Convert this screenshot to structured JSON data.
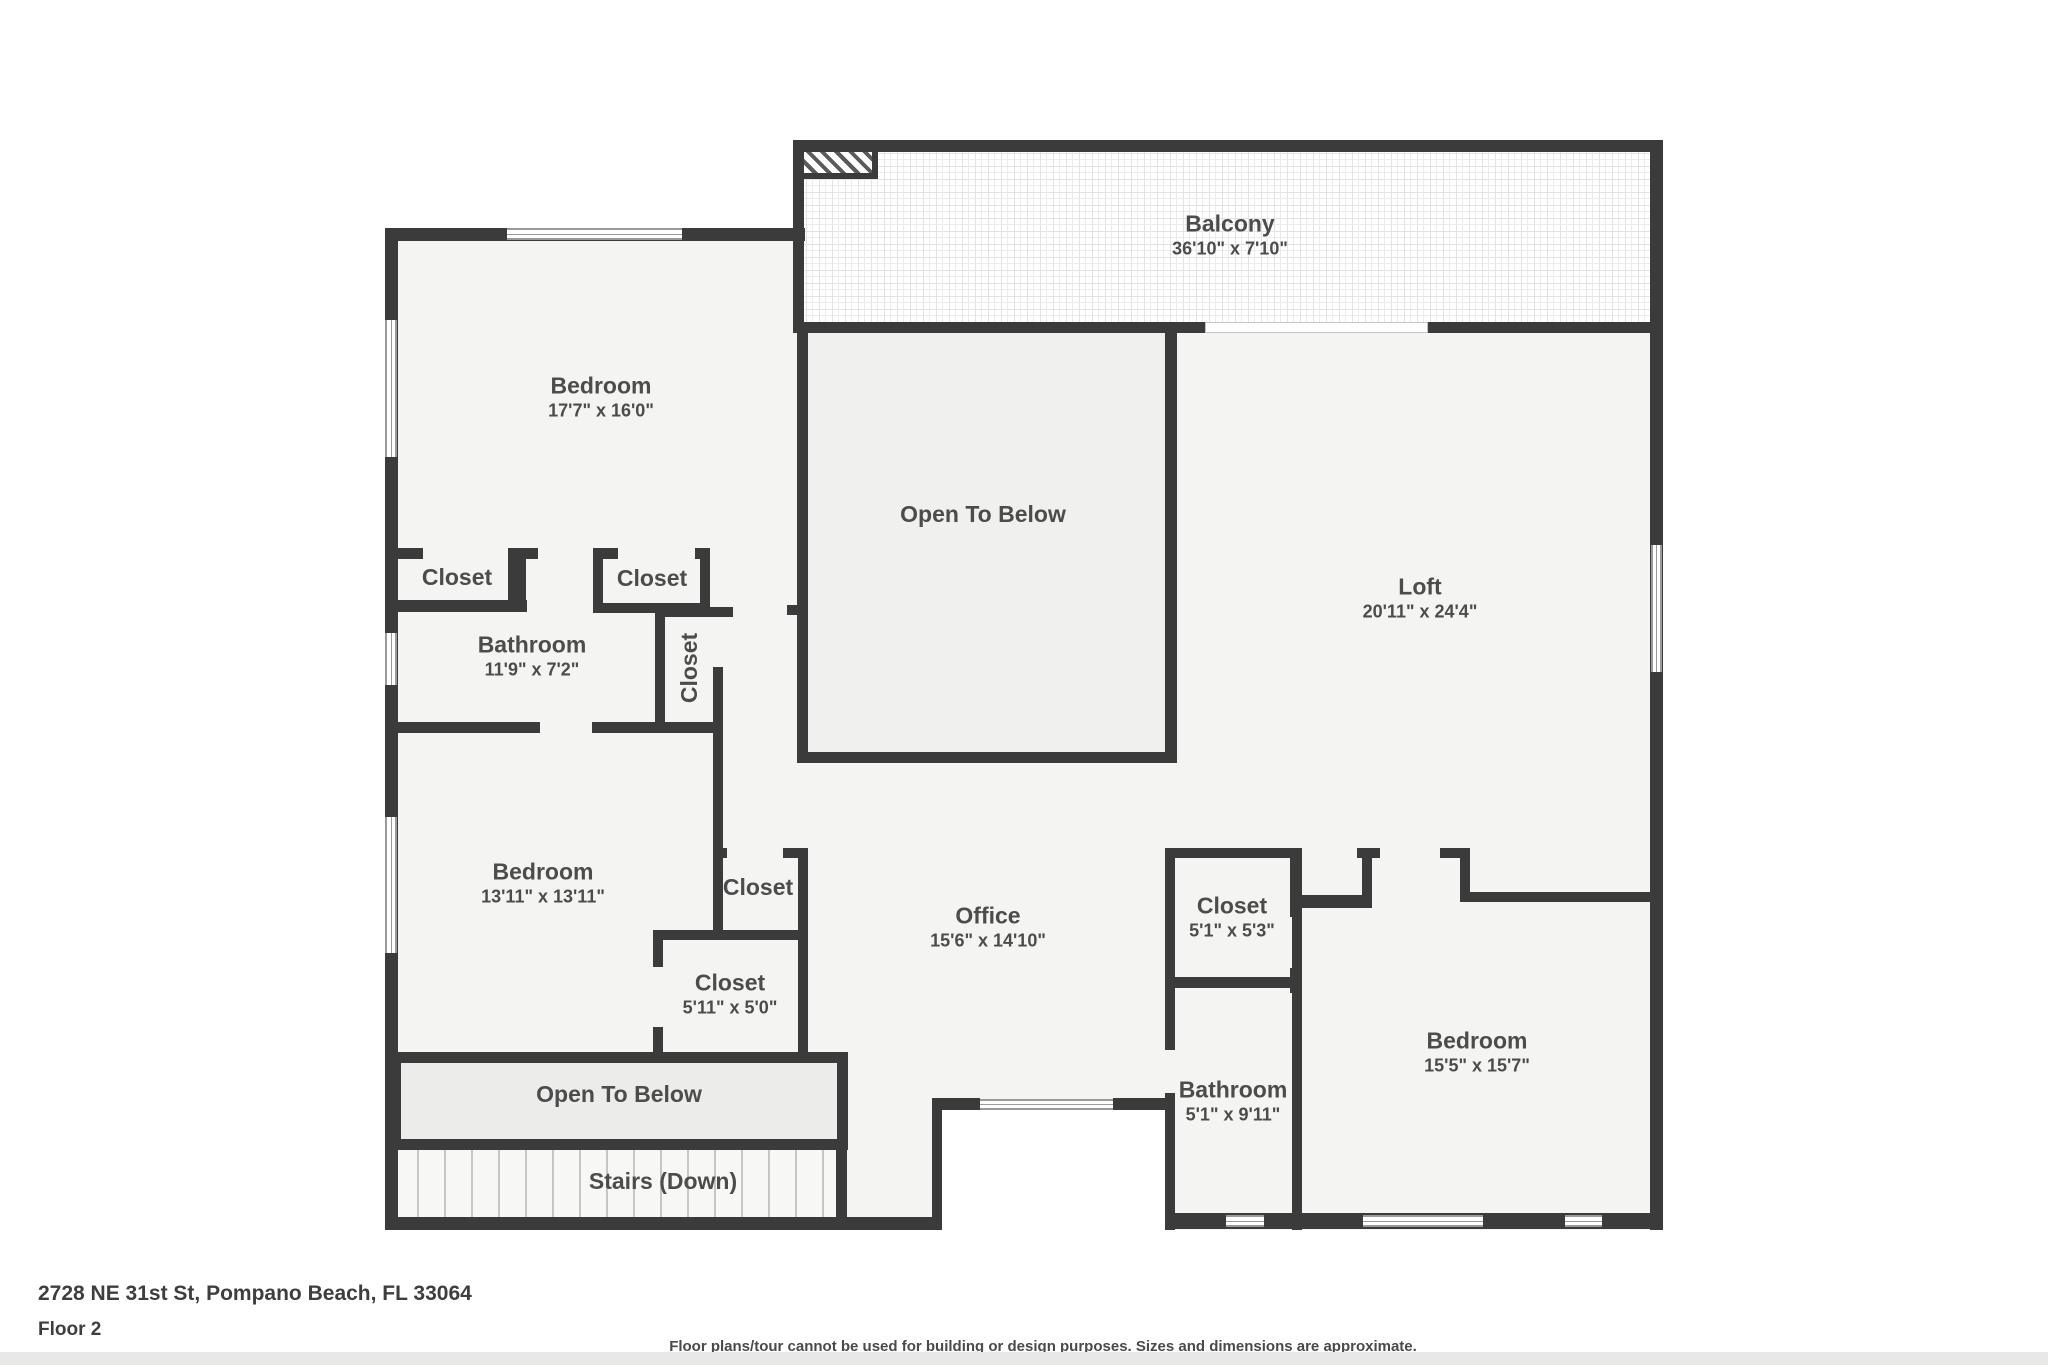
{
  "rooms": [
    {
      "id": "balcony",
      "label": "Balcony",
      "dims": "36'10\" x 7'10\""
    },
    {
      "id": "bedroom-top-left",
      "label": "Bedroom",
      "dims": "17'7\" x 16'0\""
    },
    {
      "id": "open-to-below-center",
      "label": "Open To Below"
    },
    {
      "id": "loft",
      "label": "Loft",
      "dims": "20'11\" x 24'4\""
    },
    {
      "id": "closet-left",
      "label": "Closet"
    },
    {
      "id": "closet-mid",
      "label": "Closet"
    },
    {
      "id": "bathroom-left",
      "label": "Bathroom",
      "dims": "11'9\" x 7'2\""
    },
    {
      "id": "closet-vertical",
      "label": "Closet"
    },
    {
      "id": "bedroom-mid-left",
      "label": "Bedroom",
      "dims": "13'11\" x 13'11\""
    },
    {
      "id": "closet-small",
      "label": "Closet"
    },
    {
      "id": "closet-walkin",
      "label": "Closet",
      "dims": "5'11\" x 5'0\""
    },
    {
      "id": "office",
      "label": "Office",
      "dims": "15'6\" x 14'10\""
    },
    {
      "id": "closet-bedroom-right",
      "label": "Closet",
      "dims": "5'1\" x 5'3\""
    },
    {
      "id": "bathroom-right",
      "label": "Bathroom",
      "dims": "5'1\" x 9'11\""
    },
    {
      "id": "bedroom-bottom-right",
      "label": "Bedroom",
      "dims": "15'5\" x 15'7\""
    },
    {
      "id": "open-to-below-bottom",
      "label": "Open To Below"
    },
    {
      "id": "stairs",
      "label": "Stairs (Down)"
    }
  ],
  "footer": {
    "address": "2728 NE 31st St, Pompano Beach, FL 33064",
    "floor_label": "Floor 2",
    "disclaimer": "Floor plans/tour cannot be used for building or design purposes. Sizes and dimensions are approximate."
  },
  "colors": {
    "wall": "#3b3b3b",
    "floor": "#f4f4f2",
    "background": "#ffffff",
    "label_text": "#4c4c4c"
  }
}
